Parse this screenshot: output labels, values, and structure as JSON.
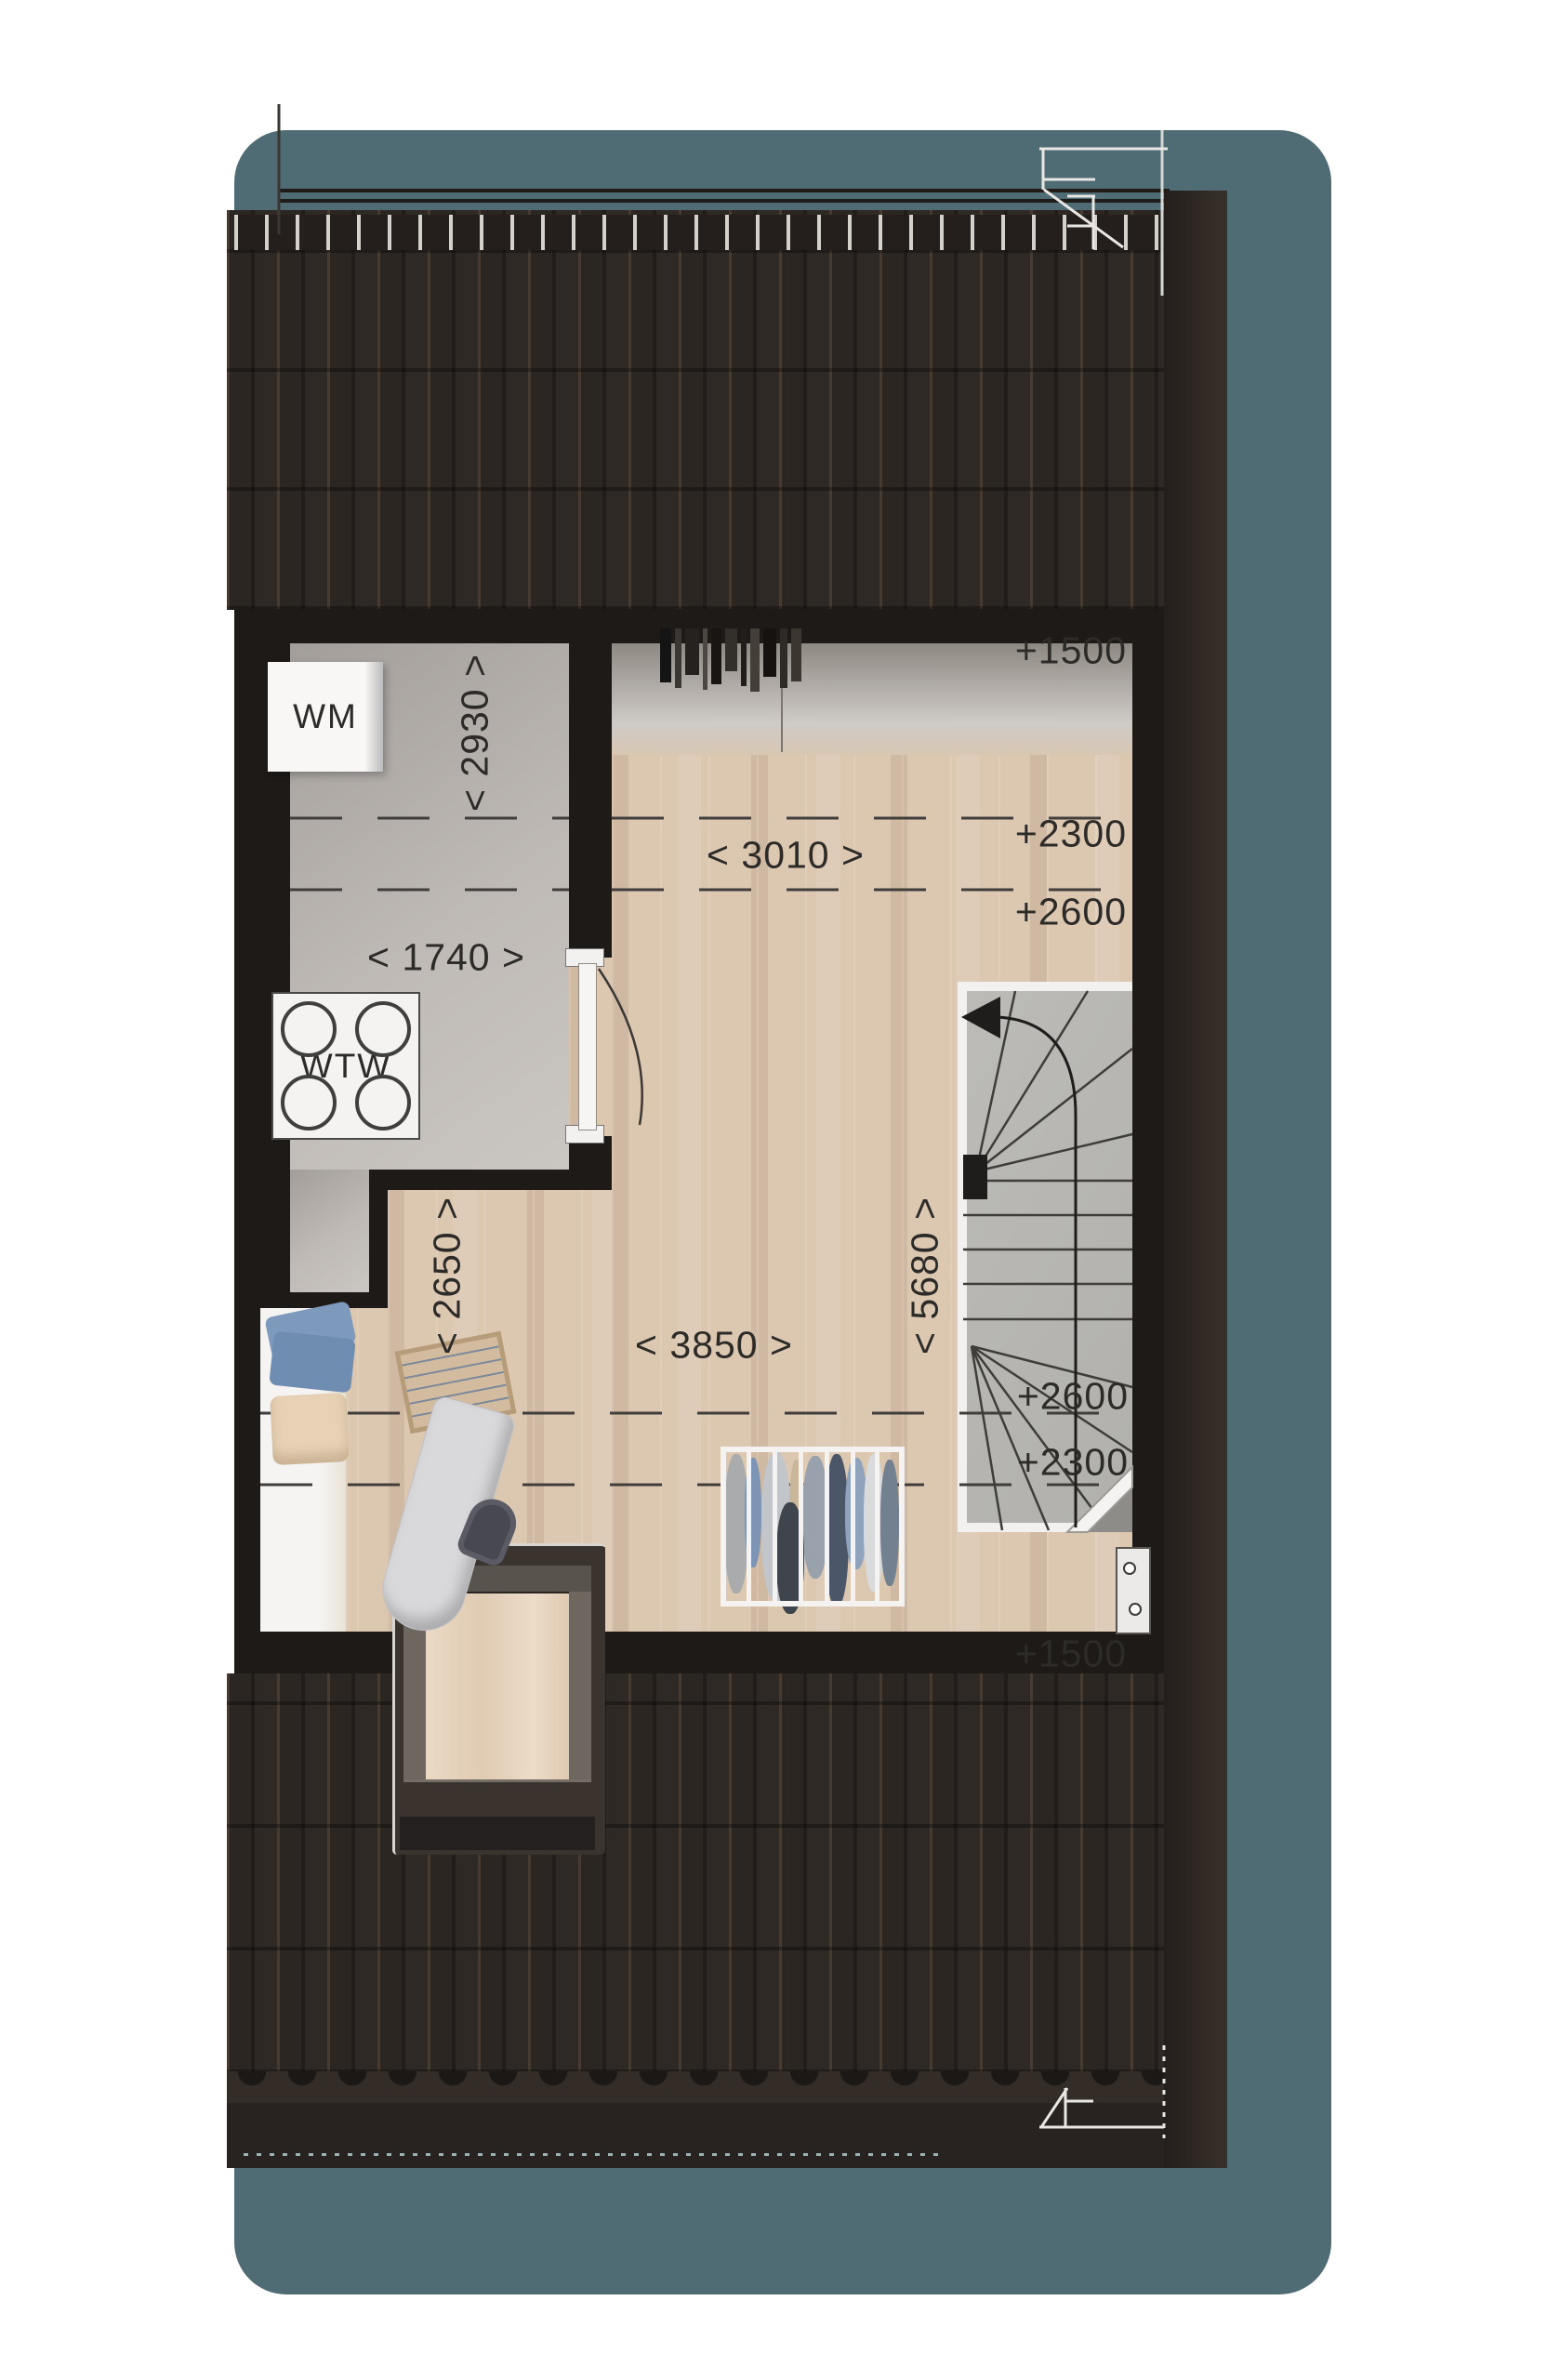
{
  "drawing": {
    "type": "attic-floor-plan",
    "labels": {
      "wm": "WM",
      "wtw": "WTW"
    },
    "dimensions": {
      "laundry_depth": "< 2930 >",
      "laundry_width": "< 1740 >",
      "landing_width": "< 3010 >",
      "left_depth": "< 2650 >",
      "room_width": "< 3850 >",
      "right_depth": "< 5680 >"
    },
    "height_markers": {
      "top_1500": "+1500",
      "top_2300": "+2300",
      "top_2600": "+2600",
      "bottom_2600": "+2600",
      "bottom_2300": "+2300",
      "bottom_1500": "+1500"
    },
    "colors": {
      "backdrop_teal": "#4f6b73",
      "roof_dark": "#2c2623",
      "wall_black": "#1d1a17",
      "wood_floor": "#dcc7b1",
      "laundry_floor": "#b6b1ad",
      "stair_concrete": "#b8b7b3",
      "dimension_text": "#2d2b28"
    }
  }
}
